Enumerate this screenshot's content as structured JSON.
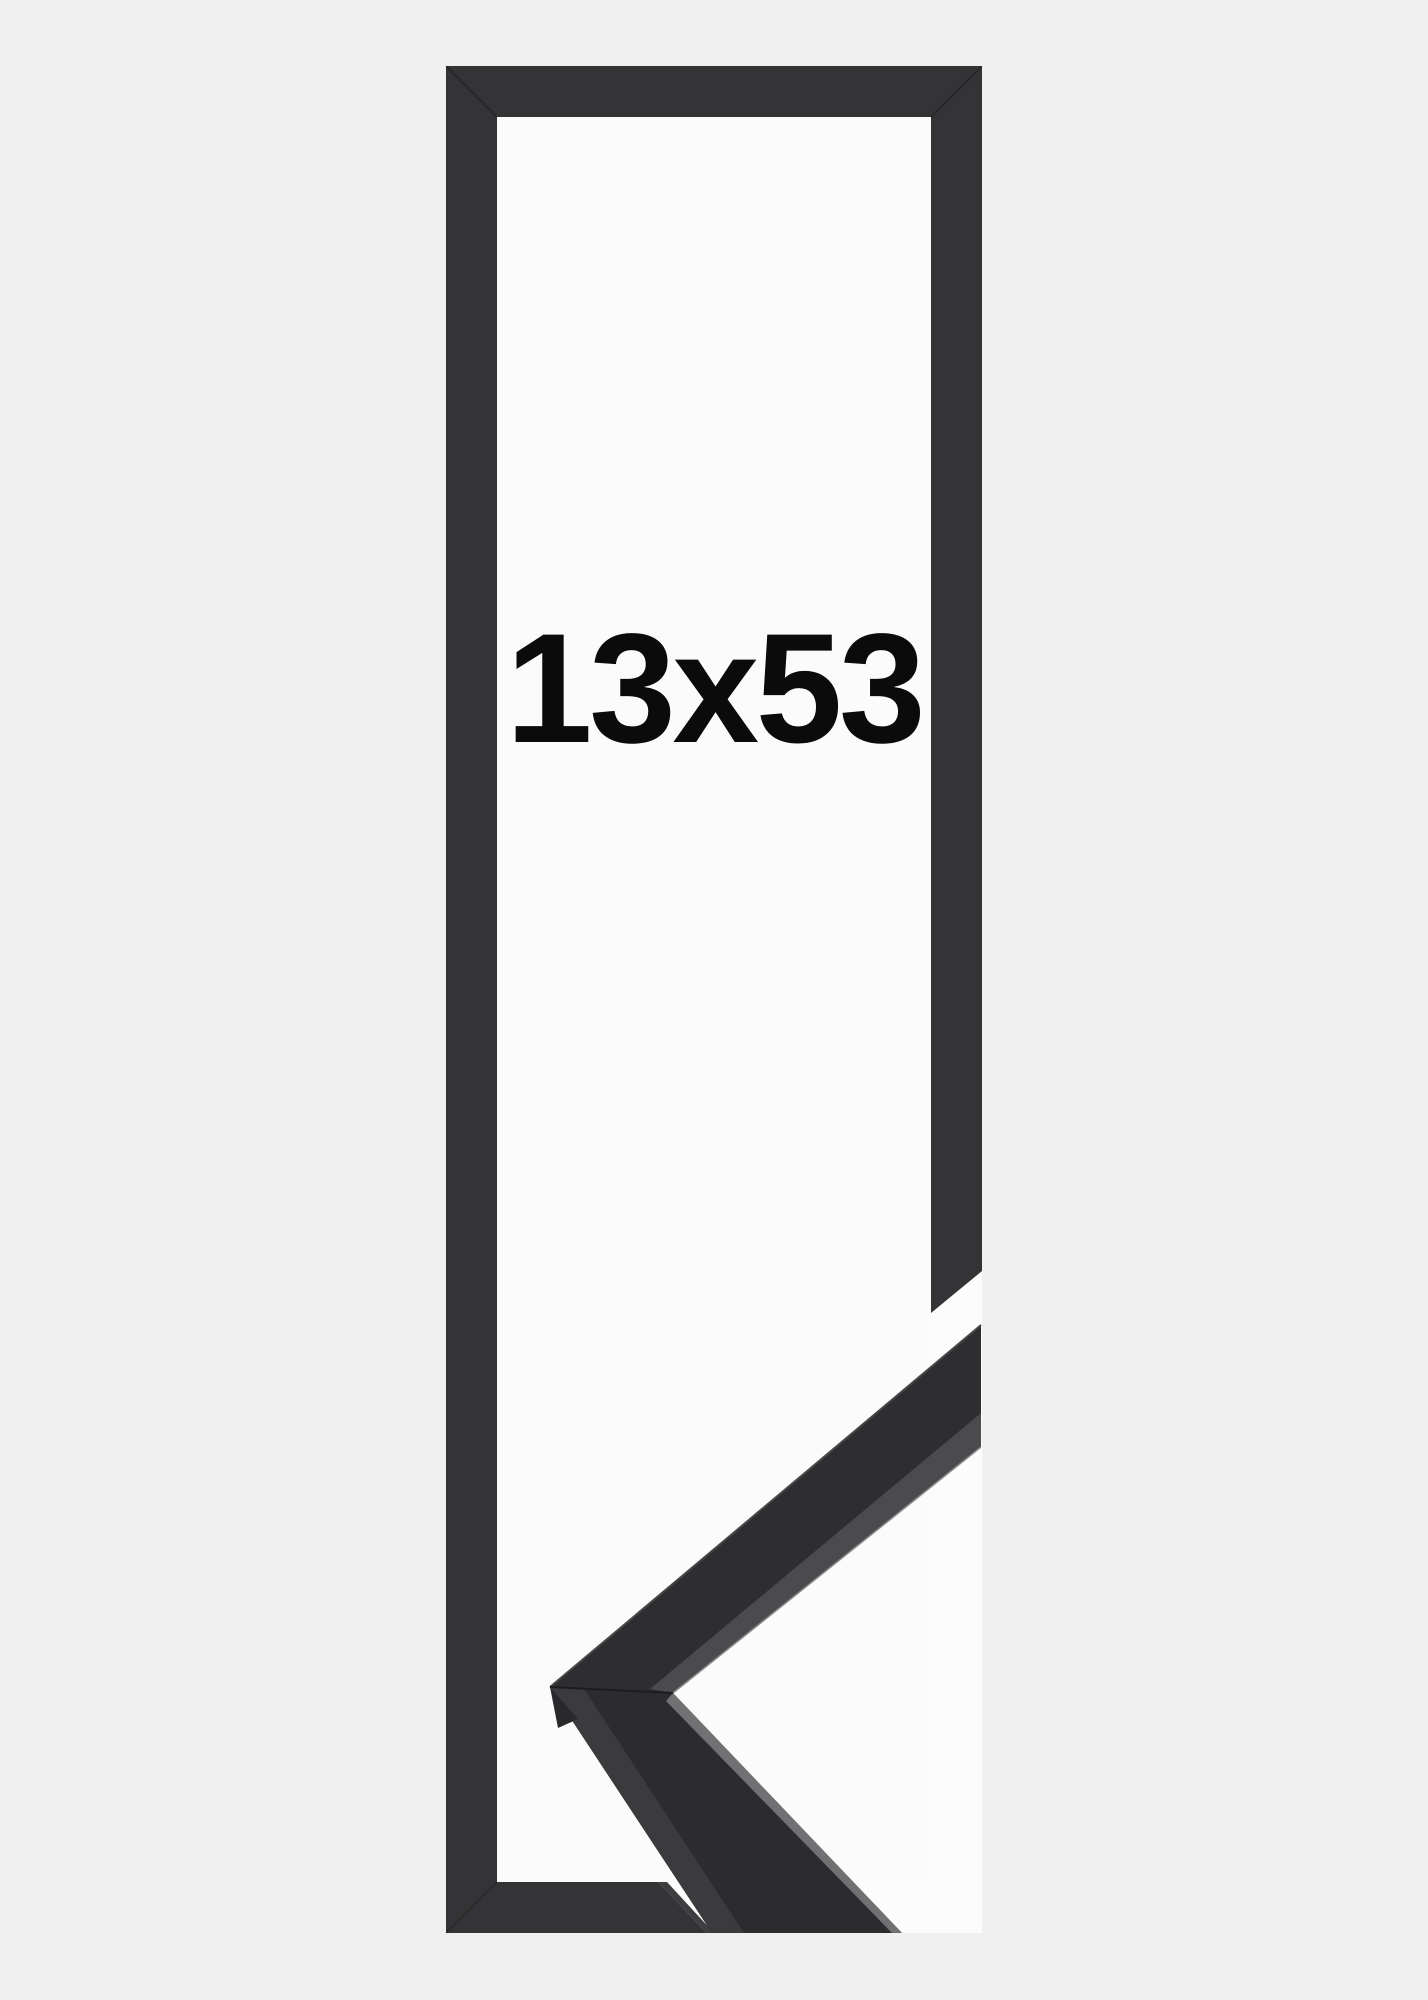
{
  "image": {
    "size_label": "13x53",
    "subject": "black picture frame with corner moulding sample"
  },
  "colors": {
    "background": "#f0f0f1",
    "frame_interior": "#fbfbfc",
    "photo_white": "#fcfcfd",
    "frame_bar": "#343436",
    "frame_bar_cut_face": "#3e3e41",
    "frame_corner_seam": "rgba(0,0,0,0.28)",
    "moulding_face_upper": "#2e2e30",
    "moulding_face_lower": "#2c2c2e",
    "moulding_top_strip": "#3b3b3e",
    "moulding_lip_strip": "#4b4b4e",
    "edge_highlight": "#717174",
    "lip_highlight": "#8a8a8d",
    "outer_edge_highlight": "#47474a",
    "miter_seam": "#1d1d1f",
    "corner_facet": "#29292b",
    "label_text": "#0b0b0c"
  }
}
